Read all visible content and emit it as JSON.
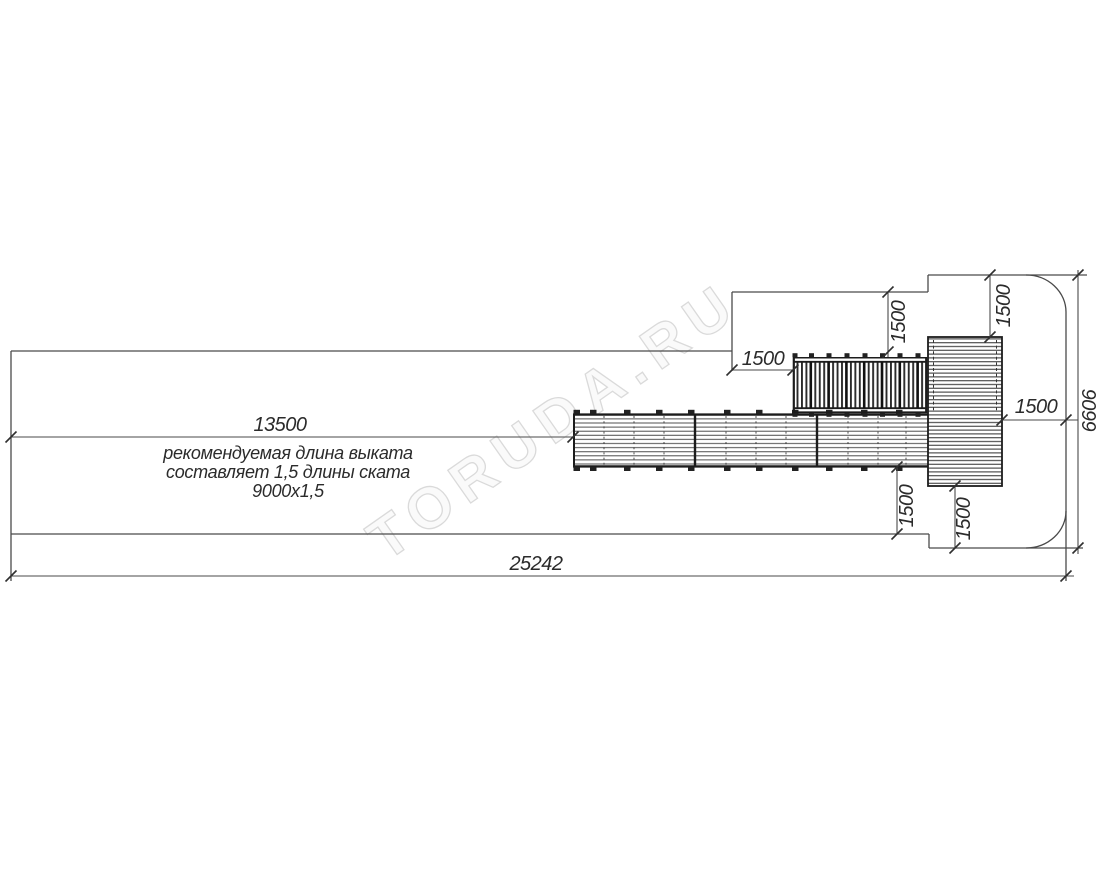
{
  "drawing": {
    "type": "plan-view technical drawing of playground slide run-out zone",
    "watermark": "TORUDA.RU",
    "dimensions": {
      "runout_length": "13500",
      "total_length": "25242",
      "total_height": "6606",
      "clearance_left_of_ladder": "1500",
      "clearance_above_ladder": "1500",
      "clearance_above_platform": "1500",
      "clearance_right_of_platform": "1500",
      "clearance_below_ramp": "1500",
      "clearance_below_platform": "1500"
    },
    "notes": {
      "runout_line1": "рекомендуемая длина выката",
      "runout_line2": "составляет 1,5 длины ската",
      "runout_line3": "9000х1,5"
    },
    "colors": {
      "line": "#4a4a4a",
      "equipment": "#1c1c1c",
      "text": "#2b2b2b",
      "watermark": "#dadada",
      "background": "#ffffff"
    }
  }
}
